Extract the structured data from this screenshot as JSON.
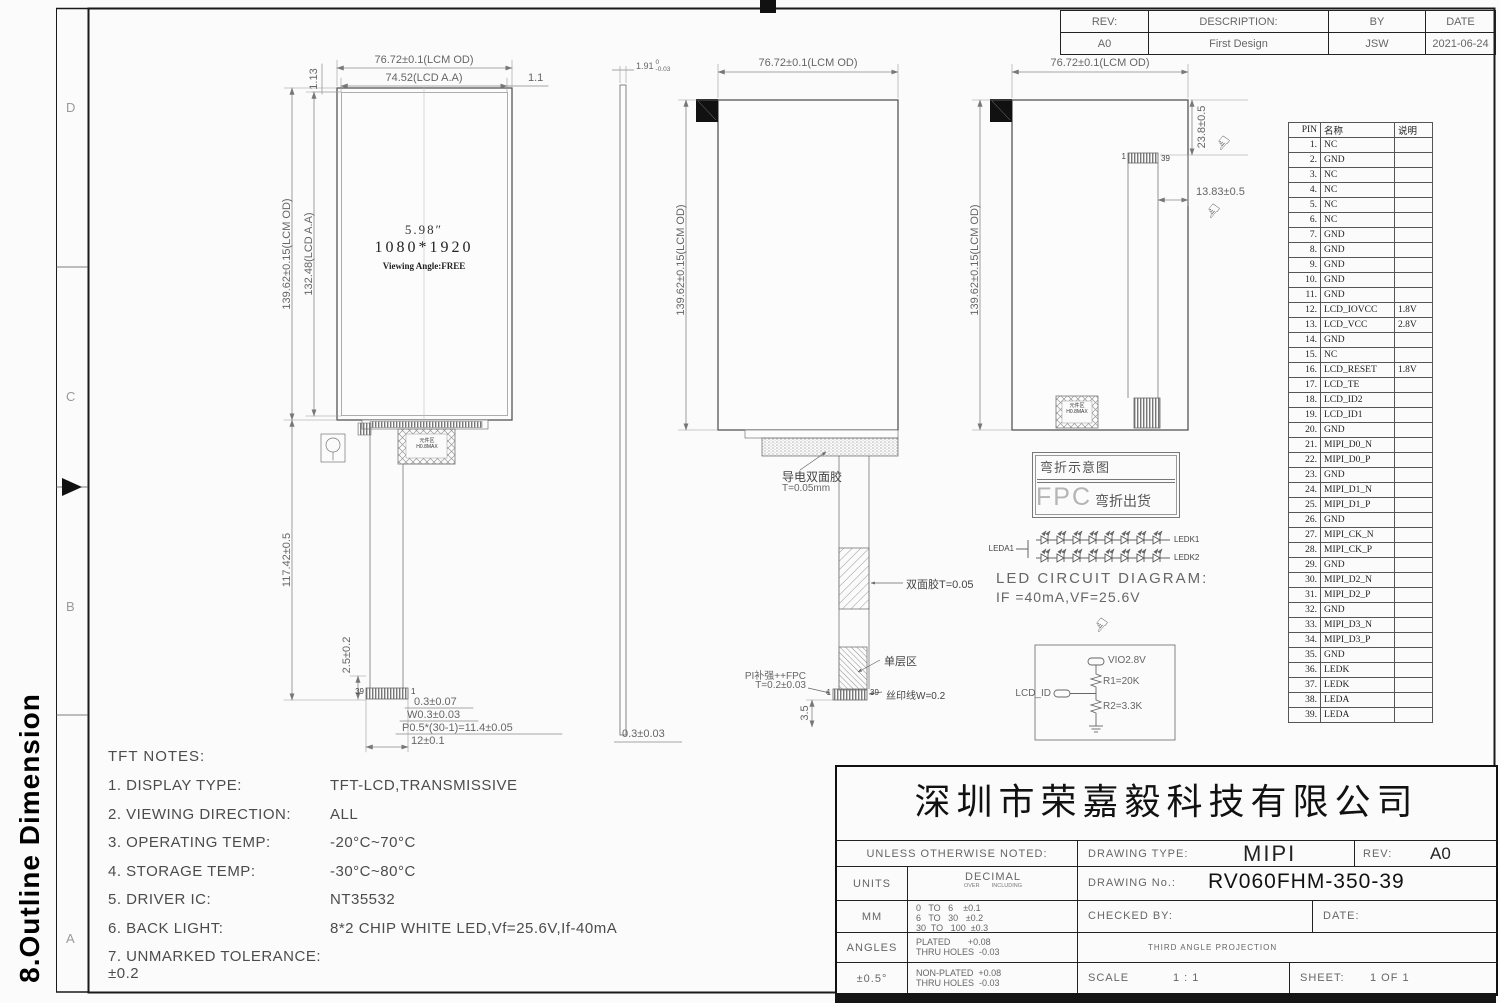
{
  "sheet": {
    "section_title": "8.Outline Dimension",
    "zones_left": [
      "D",
      "C",
      "B",
      "A"
    ],
    "zone_right": "A"
  },
  "icons": {
    "hand": "☞"
  },
  "revision_table": {
    "header_rows": [
      [
        "REV:",
        "DESCRIPTION:",
        "BY",
        "DATE"
      ]
    ],
    "rows": [
      [
        "A0",
        "First Design",
        "JSW",
        "2021-06-24"
      ]
    ]
  },
  "pin_table": {
    "header_rows": [
      [
        "PIN",
        "名称",
        "说明"
      ]
    ],
    "rows": [
      [
        "1.",
        "NC",
        ""
      ],
      [
        "2.",
        "GND",
        ""
      ],
      [
        "3.",
        "NC",
        ""
      ],
      [
        "4.",
        "NC",
        ""
      ],
      [
        "5.",
        "NC",
        ""
      ],
      [
        "6.",
        "NC",
        ""
      ],
      [
        "7.",
        "GND",
        ""
      ],
      [
        "8.",
        "GND",
        ""
      ],
      [
        "9.",
        "GND",
        ""
      ],
      [
        "10.",
        "GND",
        ""
      ],
      [
        "11.",
        "GND",
        ""
      ],
      [
        "12.",
        "LCD_IOVCC",
        "1.8V"
      ],
      [
        "13.",
        "LCD_VCC",
        "2.8V"
      ],
      [
        "14.",
        "GND",
        ""
      ],
      [
        "15.",
        "NC",
        ""
      ],
      [
        "16.",
        "LCD_RESET",
        "1.8V"
      ],
      [
        "17.",
        "LCD_TE",
        ""
      ],
      [
        "18.",
        "LCD_ID2",
        ""
      ],
      [
        "19.",
        "LCD_ID1",
        ""
      ],
      [
        "20.",
        "GND",
        ""
      ],
      [
        "21.",
        "MIPI_D0_N",
        ""
      ],
      [
        "22.",
        "MIPI_D0_P",
        ""
      ],
      [
        "23.",
        "GND",
        ""
      ],
      [
        "24.",
        "MIPI_D1_N",
        ""
      ],
      [
        "25.",
        "MIPI_D1_P",
        ""
      ],
      [
        "26.",
        "GND",
        ""
      ],
      [
        "27.",
        "MIPI_CK_N",
        ""
      ],
      [
        "28.",
        "MIPI_CK_P",
        ""
      ],
      [
        "29.",
        "GND",
        ""
      ],
      [
        "30.",
        "MIPI_D2_N",
        ""
      ],
      [
        "31.",
        "MIPI_D2_P",
        ""
      ],
      [
        "32.",
        "GND",
        ""
      ],
      [
        "33.",
        "MIPI_D3_N",
        ""
      ],
      [
        "34.",
        "MIPI_D3_P",
        ""
      ],
      [
        "35.",
        "GND",
        ""
      ],
      [
        "36.",
        "LEDK",
        ""
      ],
      [
        "37.",
        "LEDK",
        ""
      ],
      [
        "38.",
        "LEDA",
        ""
      ],
      [
        "39.",
        "LEDA",
        ""
      ]
    ]
  },
  "views": {
    "front": {
      "dim_lcm_od_w": "76.72±0.1(LCM OD)",
      "dim_aa_w": "74.52(LCD A.A)",
      "dim_right_gap": "1.1",
      "dim_left_gap": "1.13",
      "dim_lcm_od_h": "139.62±0.15(LCM OD)",
      "dim_aa_h": "132.48(LCD A.A)",
      "dim_fpc_len": "117.42±0.5",
      "dim_tail": "2.5±0.2",
      "size_label": "5.98″",
      "resolution": "1080*1920",
      "viewing": "Viewing Angle:FREE",
      "pin_left": "39",
      "pin_right": "1",
      "dim_b1": "0.3±0.07",
      "dim_b2": "W0.3±0.03",
      "dim_b3": "P0.5*(30-1)=11.4±0.05",
      "dim_b4": "12±0.1",
      "comp_area_1": "元件区",
      "comp_area_2": "H0.8MAX"
    },
    "side": {
      "thickness": "1.91",
      "tol_top": "0",
      "tol_bot": "-0.03",
      "dim_bottom": "0.3±0.03"
    },
    "rear": {
      "dim_w": "76.72±0.1(LCM OD)",
      "dim_h": "139.62±0.15(LCM OD)",
      "adhesive_1": "导电双面胶",
      "adhesive_2": "T=0.05mm",
      "tape_label": "双面胶T=0.05",
      "single_layer": "单层区",
      "pi_1": "PI补强++FPC",
      "pi_2": "T=0.2±0.03",
      "silk": "丝印线W=0.2",
      "dim_tail": "3.5",
      "pin_left": "1",
      "pin_right": "39"
    },
    "folded": {
      "dim_w": "76.72±0.1(LCM OD)",
      "dim_h": "139.62±0.15(LCM OD)",
      "dim_fold_v": "23.8±0.5",
      "dim_fold_h": "13.83±0.5",
      "pin_left": "1",
      "pin_right": "39",
      "comp_area_1": "元件区",
      "comp_area_2": "H0.8MAX",
      "fold_line1": "弯折示意图",
      "fold_fpc": "FPC",
      "fold_line2": "弯折出货"
    }
  },
  "led_circuit": {
    "anode": "LEDA1",
    "k1": "LEDK1",
    "k2": "LEDK2",
    "title": "LED CIRCUIT DIAGRAM:",
    "spec": "IF =40mA,VF=25.6V"
  },
  "id_circuit": {
    "vio": "VIO2.8V",
    "r1": "R1=20K",
    "r2": "R2=3.3K",
    "signal": "LCD_ID"
  },
  "notes": {
    "title": "TFT NOTES:",
    "items": [
      {
        "label": "1. DISPLAY TYPE:",
        "value": "TFT-LCD,TRANSMISSIVE"
      },
      {
        "label": "2. VIEWING DIRECTION:",
        "value": "ALL"
      },
      {
        "label": "3. OPERATING TEMP:",
        "value": "-20°C~70°C"
      },
      {
        "label": "4. STORAGE TEMP:",
        "value": "-30°C~80°C"
      },
      {
        "label": "5. DRIVER IC:",
        "value": "NT35532"
      },
      {
        "label": "6. BACK LIGHT:",
        "value": "8*2 CHIP WHITE LED,Vf=25.6V,If-40mA"
      },
      {
        "label": "7. UNMARKED TOLERANCE:±0.2",
        "value": ""
      }
    ]
  },
  "title_block": {
    "company": "深圳市荣嘉毅科技有限公司",
    "unless": "UNLESS OTHERWISE NOTED:",
    "drawing_type_label": "DRAWING TYPE:",
    "drawing_type": "MIPI",
    "rev_label": "REV:",
    "rev": "A0",
    "units_label": "UNITS",
    "decimal_label": "DECIMAL",
    "over_including": "OVER        INCLUDING",
    "drawing_no_label": "DRAWING No.:",
    "drawing_no": "RV060FHM-350-39",
    "mm": "MM",
    "tol_line1": "0   TO   6    ±0.1",
    "tol_line2": "6   TO   30   ±0.2",
    "tol_line3": "30  TO   100  ±0.3",
    "checked_by": "CHECKED BY:",
    "date_label": "DATE:",
    "angles_label": "ANGLES",
    "plated_1": "PLATED       +0.08",
    "plated_2": "THRU HOLES  -0.03",
    "angle_tol": "±0.5°",
    "nonplated_1": "NON-PLATED  +0.08",
    "nonplated_2": "THRU HOLES  -0.03",
    "projection": "THIRD ANGLE PROJECTION",
    "scale_label": "SCALE",
    "scale": "1  :  1",
    "sheet_label": "SHEET:",
    "sheet": "1  OF  1"
  }
}
